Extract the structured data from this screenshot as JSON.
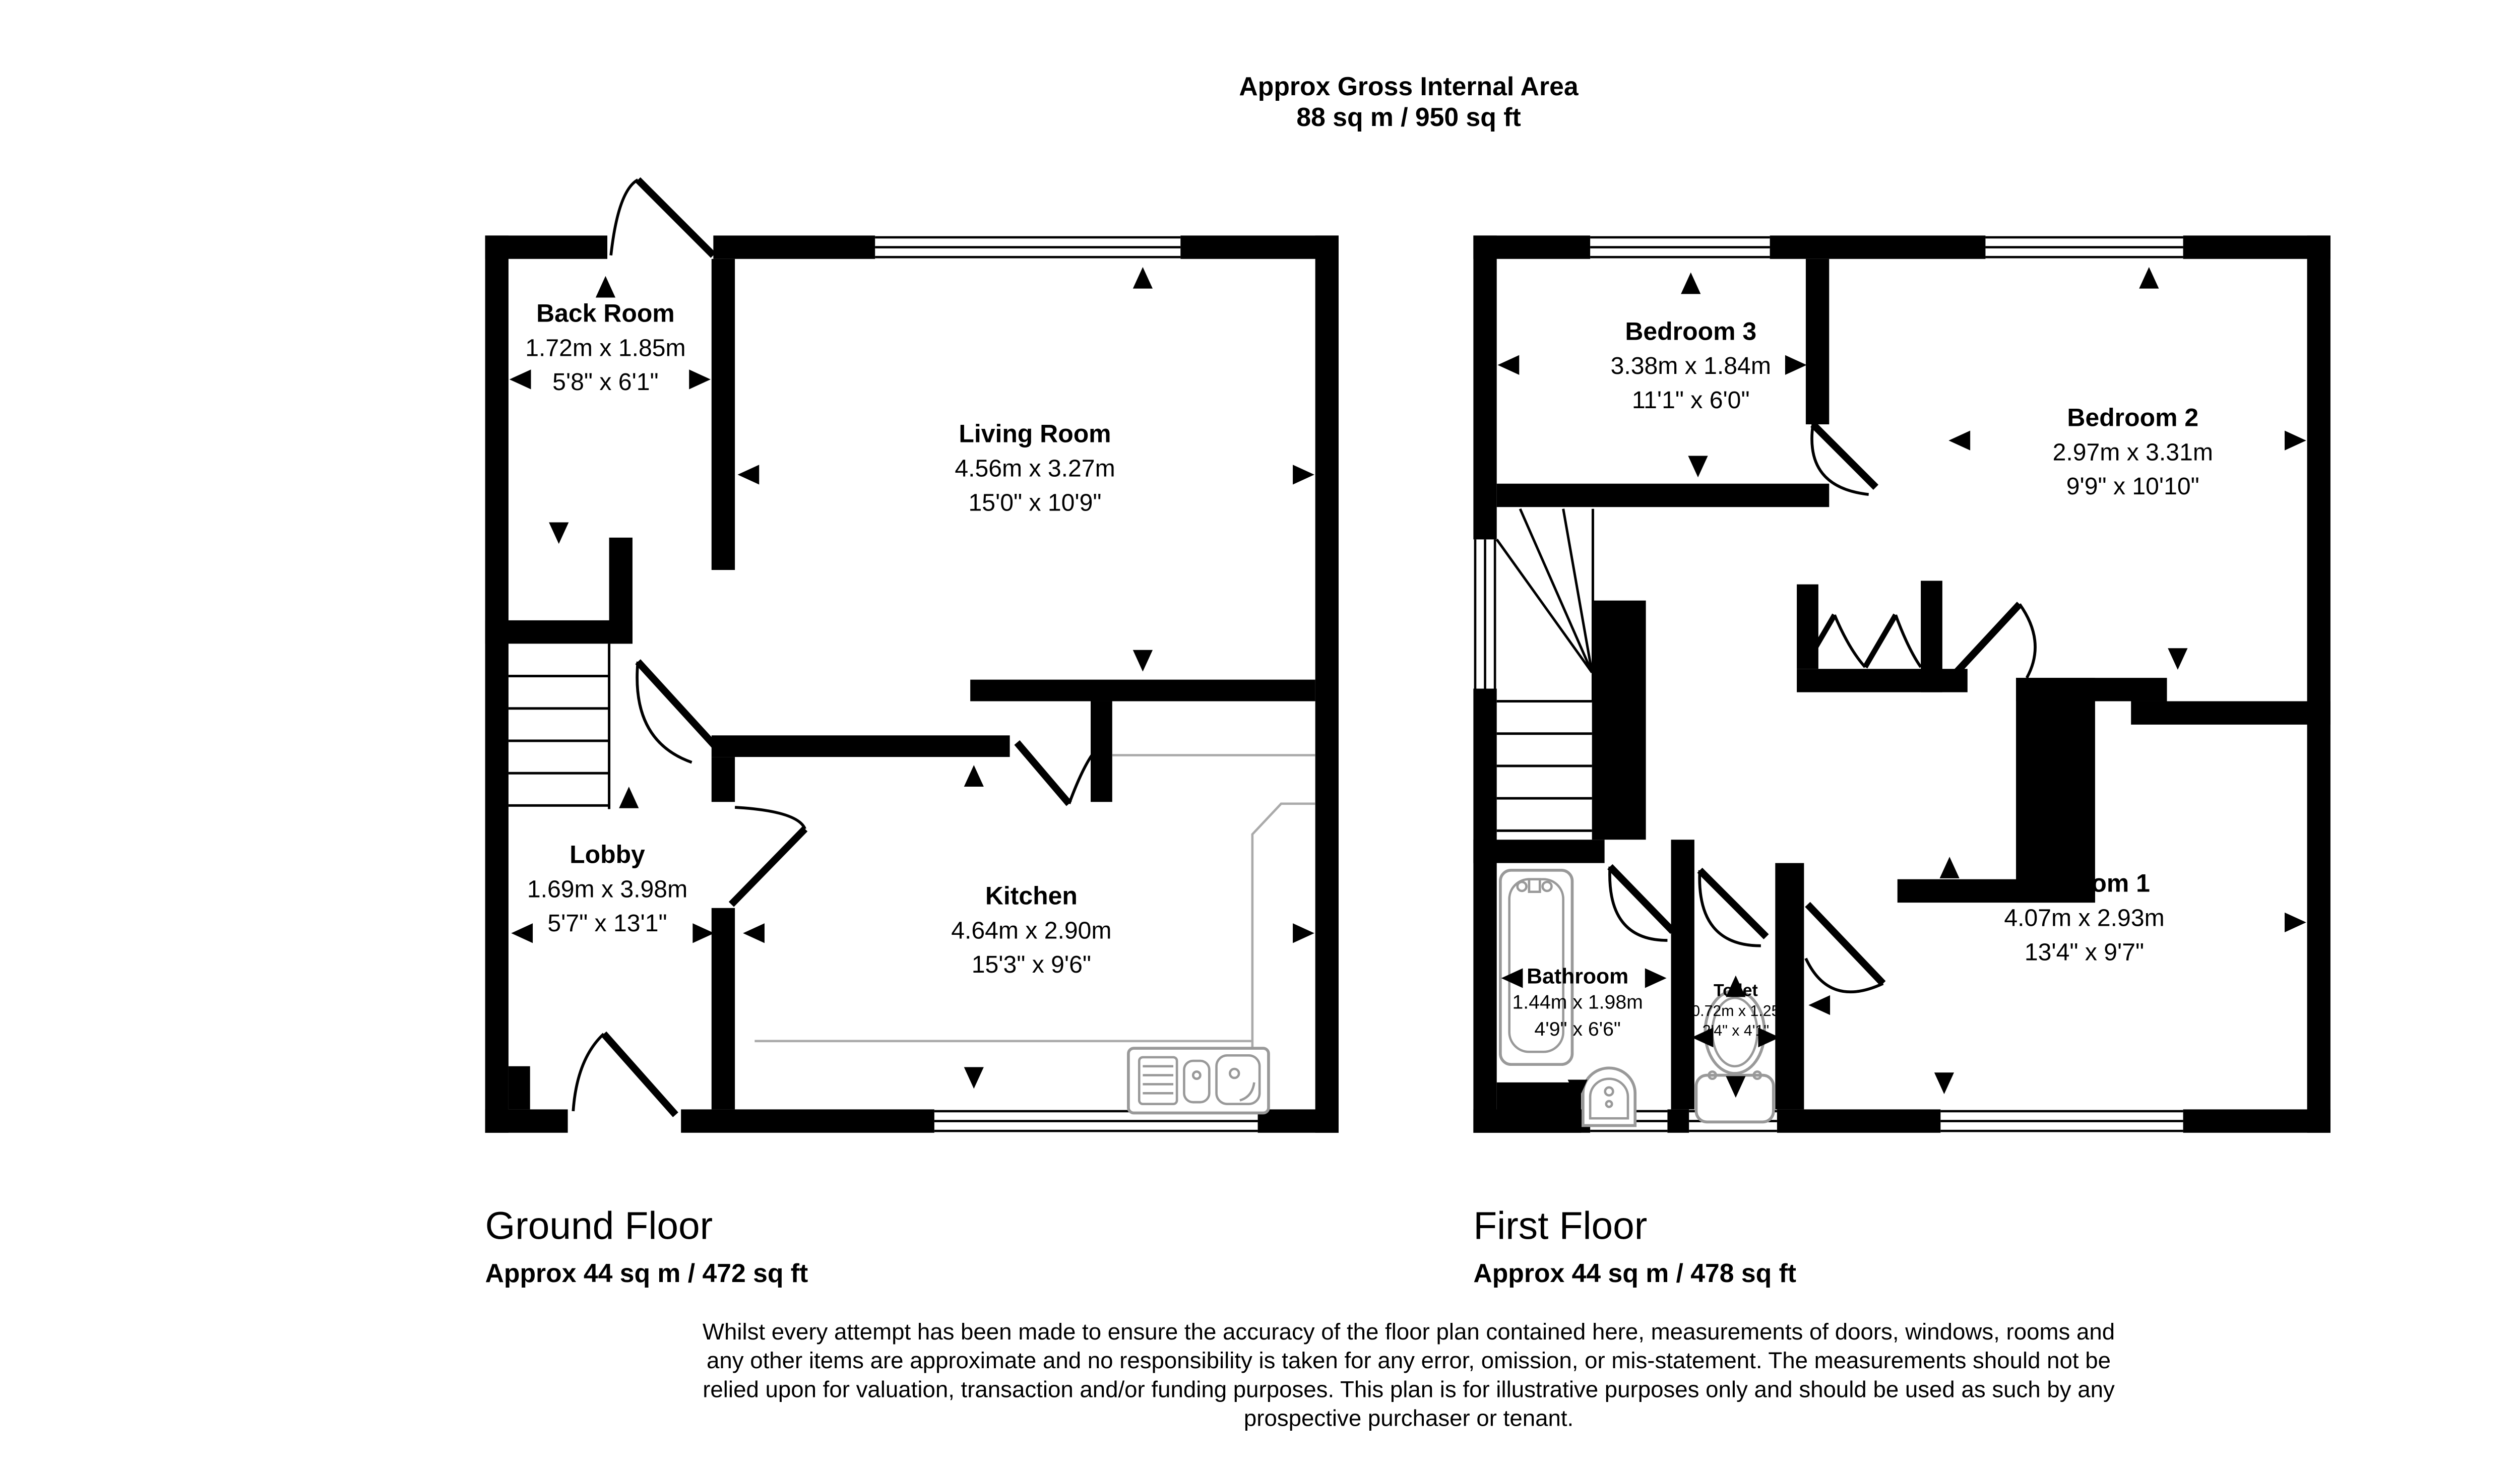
{
  "header": {
    "title": "Approx Gross Internal Area",
    "subtitle": "88 sq m / 950 sq ft"
  },
  "ground_floor": {
    "label": "Ground Floor",
    "area": "Approx 44 sq m / 472 sq ft",
    "rooms": [
      {
        "name": "Back Room",
        "metric": "1.72m x 1.85m",
        "imperial": "5'8\" x 6'1\""
      },
      {
        "name": "Living Room",
        "metric": "4.56m x 3.27m",
        "imperial": "15'0\" x 10'9\""
      },
      {
        "name": "Lobby",
        "metric": "1.69m x 3.98m",
        "imperial": "5'7\" x 13'1\""
      },
      {
        "name": "Kitchen",
        "metric": "4.64m x 2.90m",
        "imperial": "15'3\" x 9'6\""
      }
    ]
  },
  "first_floor": {
    "label": "First Floor",
    "area": "Approx 44 sq m / 478 sq ft",
    "rooms": [
      {
        "name": "Bedroom 3",
        "metric": "3.38m x 1.84m",
        "imperial": "11'1\" x 6'0\""
      },
      {
        "name": "Bedroom 2",
        "metric": "2.97m x 3.31m",
        "imperial": "9'9\" x 10'10\""
      },
      {
        "name": "Bedroom 1",
        "metric": "4.07m x 2.93m",
        "imperial": "13'4\" x 9'7\""
      },
      {
        "name": "Bathroom",
        "metric": "1.44m x 1.98m",
        "imperial": "4'9\" x 6'6\""
      },
      {
        "name": "Toilet",
        "metric": "0.72m x 1.25",
        "imperial": "2'4\" x 4'1\""
      }
    ]
  },
  "disclaimer": [
    "Whilst every attempt has been made to ensure the accuracy of the floor plan contained here, measurements of doors, windows, rooms and",
    "any other items are approximate and no responsibility is taken for any error, omission, or mis-statement. The measurements should not be",
    "relied upon for valuation, transaction and/or funding purposes. This plan is for illustrative purposes only and should be used as such by any",
    "prospective purchaser or tenant."
  ],
  "icons": {
    "dimension_arrow": "black triangle pointer",
    "bath": "rounded rectangle tub with taps",
    "basin": "pedestal wash basin arch",
    "toilet": "oval bowl with cistern",
    "kitchen_sink": "drainer with two bowls",
    "stairs": "parallel treads",
    "door": "leaf line with quarter-circle swing arc",
    "window": "triple thin lines in wall gap"
  },
  "colors": {
    "wall": "#000000",
    "fixture_gray": "#999999",
    "background": "#ffffff"
  }
}
